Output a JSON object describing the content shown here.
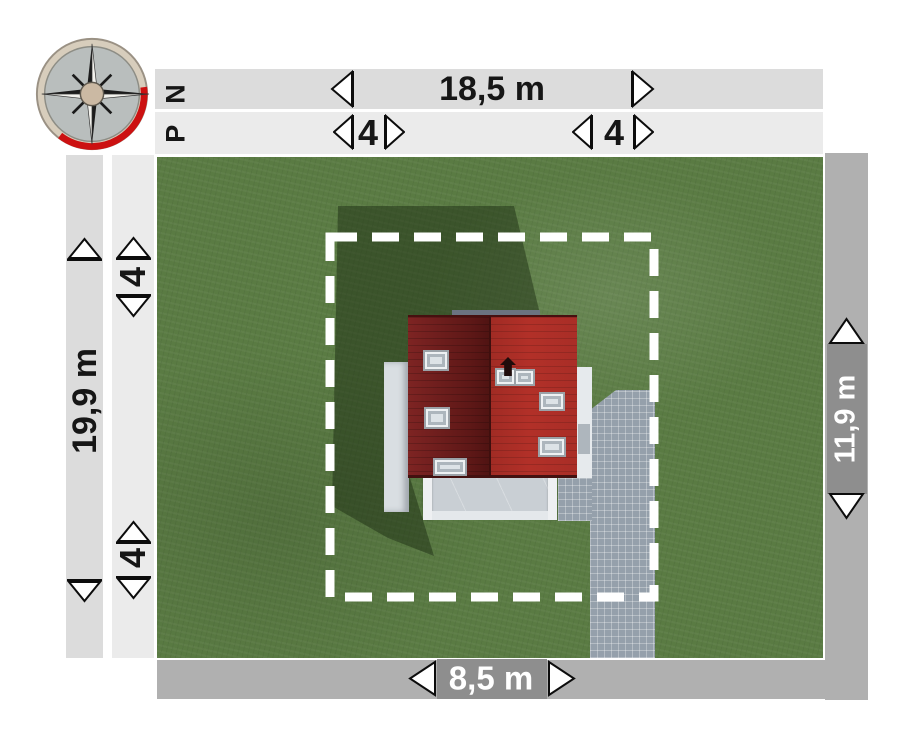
{
  "compass": {
    "label": "P N"
  },
  "dimensions": {
    "top_width": "18,5 m",
    "left_height": "19,9 m",
    "right_height": "11,9 m",
    "bottom_width": "8,5 m",
    "setback_top_left": "4",
    "setback_top_right": "4",
    "setback_left_top": "4",
    "setback_left_bottom": "4"
  },
  "colors": {
    "band_outer": "#dcdcdc",
    "band_inner": "#ebebeb",
    "band_dark": "#b0b0b0",
    "chip": "#8e8e8e",
    "grass": "#5a7b43",
    "roof_dark": "#6e1d1c",
    "roof_bright": "#b13129",
    "paving": "#95a0ab",
    "boundary_dash": "#ffffff",
    "compass_red": "#cc1111",
    "text_dark": "#161616",
    "text_light": "#ffffff"
  }
}
